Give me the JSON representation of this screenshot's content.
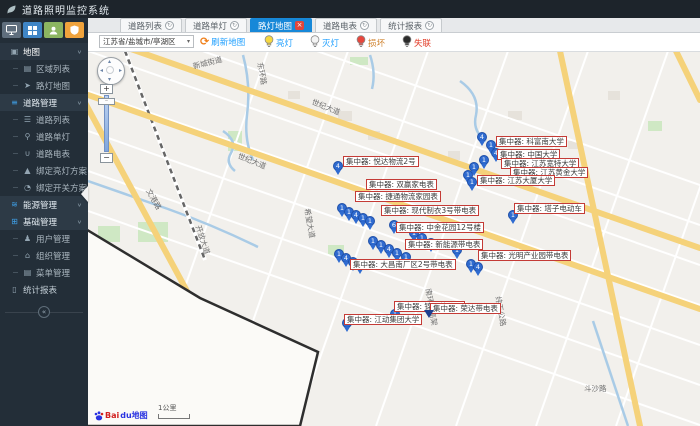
{
  "app": {
    "title": "道路照明监控系统"
  },
  "ui": {
    "refresh_glyph": "↻",
    "close_glyph": "×",
    "chevron": "∨",
    "caret": "▾",
    "collapse_glyph": "«",
    "refresh_icon_glyph": "⟳",
    "zoom_in": "+",
    "zoom_out": "−",
    "handle_glyph": "‒"
  },
  "sidebar": {
    "quick_buttons": [
      {
        "id": "monitor",
        "color": "#5f6e7d"
      },
      {
        "id": "grid",
        "color": "#3f85c6"
      },
      {
        "id": "user",
        "color": "#8cb561"
      },
      {
        "id": "shield",
        "color": "#f0a33c"
      }
    ],
    "items": [
      {
        "id": "map",
        "label": "地图",
        "icon": "▣",
        "child": false,
        "chevron": true,
        "accent": false,
        "active": true
      },
      {
        "id": "region-list",
        "label": "区域列表",
        "icon": "▤",
        "child": true,
        "chevron": false,
        "accent": false,
        "active": false
      },
      {
        "id": "lamp-map",
        "label": "路灯地图",
        "icon": "➤",
        "child": true,
        "chevron": false,
        "accent": false,
        "active": false
      },
      {
        "id": "road-manage",
        "label": "道路管理",
        "icon": "≡",
        "child": false,
        "chevron": true,
        "accent": true,
        "active": false
      },
      {
        "id": "road-list",
        "label": "道路列表",
        "icon": "☰",
        "child": true,
        "chevron": false,
        "accent": false,
        "active": false
      },
      {
        "id": "road-lamp",
        "label": "道路单灯",
        "icon": "⚲",
        "child": true,
        "chevron": false,
        "accent": false,
        "active": false
      },
      {
        "id": "road-meter",
        "label": "道路电表",
        "icon": "∪",
        "child": true,
        "chevron": false,
        "accent": false,
        "active": false
      },
      {
        "id": "bind-light-plan",
        "label": "绑定亮灯方案",
        "icon": "▲",
        "child": true,
        "chevron": false,
        "accent": false,
        "active": false
      },
      {
        "id": "bind-switch-plan",
        "label": "绑定开关方案",
        "icon": "◔",
        "child": true,
        "chevron": false,
        "accent": false,
        "active": false
      },
      {
        "id": "energy-manage",
        "label": "能源管理",
        "icon": "≋",
        "child": false,
        "chevron": true,
        "accent": true,
        "active": false
      },
      {
        "id": "base-manage",
        "label": "基础管理",
        "icon": "⊞",
        "child": false,
        "chevron": true,
        "accent": true,
        "active": false
      },
      {
        "id": "user-manage",
        "label": "用户管理",
        "icon": "♟",
        "child": true,
        "chevron": false,
        "accent": false,
        "active": false
      },
      {
        "id": "org-manage",
        "label": "组织管理",
        "icon": "⌂",
        "child": true,
        "chevron": false,
        "accent": false,
        "active": false
      },
      {
        "id": "menu-manage",
        "label": "菜单管理",
        "icon": "▤",
        "child": true,
        "chevron": false,
        "accent": false,
        "active": false
      },
      {
        "id": "report",
        "label": "统计报表",
        "icon": "▯",
        "child": false,
        "chevron": false,
        "accent": false,
        "active": false
      }
    ]
  },
  "tabs": [
    {
      "id": "road-list",
      "label": "道路列表",
      "active": false
    },
    {
      "id": "road-lamp",
      "label": "道路单灯",
      "active": false
    },
    {
      "id": "lamp-map",
      "label": "路灯地图",
      "active": true
    },
    {
      "id": "road-meter",
      "label": "道路电表",
      "active": false
    },
    {
      "id": "report",
      "label": "统计报表",
      "active": false
    }
  ],
  "toolbar": {
    "region_select": "江苏省/盐城市/亭湖区",
    "refresh_label": "刷新地图",
    "legend": [
      {
        "id": "on",
        "label": "亮灯",
        "bulb": "#f7d83f",
        "text_color": "#1E9FFF"
      },
      {
        "id": "off",
        "label": "灭灯",
        "bulb": "#f4f4f4",
        "text_color": "#1E9FFF"
      },
      {
        "id": "broken",
        "label": "损坏",
        "bulb": "#e8463c",
        "text_color": "#cf822e"
      },
      {
        "id": "offline",
        "label": "失联",
        "bulb": "#2b2b2b",
        "text_color": "#e23c28"
      }
    ]
  },
  "map": {
    "scale_label": "1公里",
    "logo_text_1": "Bai",
    "logo_text_2": "du地图",
    "road_labels": [
      {
        "text": "新城街道",
        "x": 193,
        "y": 61,
        "rot": -14
      },
      {
        "text": "东环路",
        "x": 260,
        "y": 57,
        "rot": 80
      },
      {
        "text": "世纪大道",
        "x": 312,
        "y": 96,
        "rot": 22
      },
      {
        "text": "世纪大道",
        "x": 238,
        "y": 150,
        "rot": 22
      },
      {
        "text": "文港路",
        "x": 148,
        "y": 184,
        "rot": 60
      },
      {
        "text": "开放大道",
        "x": 198,
        "y": 220,
        "rot": 72
      },
      {
        "text": "希望大道",
        "x": 307,
        "y": 203,
        "rot": 80
      },
      {
        "text": "南环路高架",
        "x": 428,
        "y": 283,
        "rot": 80
      },
      {
        "text": "纬五公路",
        "x": 498,
        "y": 291,
        "rot": 80
      },
      {
        "text": "斗沙路",
        "x": 584,
        "y": 383,
        "rot": 0
      }
    ],
    "labels": [
      {
        "x": 343,
        "y": 156,
        "text": "集中器: 悦达物流2号"
      },
      {
        "x": 366,
        "y": 179,
        "text": "集中器: 双赢家电表"
      },
      {
        "x": 355,
        "y": 191,
        "text": "集中器: 捷通物流家园表"
      },
      {
        "x": 381,
        "y": 205,
        "text": "集中器: 现代制衣3号带电表"
      },
      {
        "x": 396,
        "y": 222,
        "text": "集中器: 中金花园12号楼"
      },
      {
        "x": 405,
        "y": 239,
        "text": "集中器: 新能源带电表"
      },
      {
        "x": 350,
        "y": 259,
        "text": "集中器: 大昌南厂区2号带电表"
      },
      {
        "x": 478,
        "y": 250,
        "text": "集中器: 光明产业园带电表"
      },
      {
        "x": 496,
        "y": 136,
        "text": "集中器: 科富南大学"
      },
      {
        "x": 497,
        "y": 149,
        "text": "集中器: 中国大学"
      },
      {
        "x": 501,
        "y": 158,
        "text": "集中器: 江苏宽特大学"
      },
      {
        "x": 510,
        "y": 167,
        "text": "集中器: 江苏黄金大学"
      },
      {
        "x": 477,
        "y": 175,
        "text": "集中器: 江苏大厦大学"
      },
      {
        "x": 514,
        "y": 203,
        "text": "集中器: 塔子电动车"
      },
      {
        "x": 394,
        "y": 301,
        "text": "集中器: 锦厂幼儿园"
      },
      {
        "x": 430,
        "y": 303,
        "text": "集中器: 荣达带电表"
      },
      {
        "x": 344,
        "y": 314,
        "text": "集中器: 江动集团大学"
      }
    ],
    "markers": [
      [
        333,
        161,
        "4"
      ],
      [
        337,
        203,
        "1"
      ],
      [
        344,
        207,
        "1"
      ],
      [
        351,
        210,
        "4"
      ],
      [
        358,
        213,
        "1"
      ],
      [
        365,
        216,
        "1"
      ],
      [
        334,
        249,
        "1"
      ],
      [
        341,
        253,
        "4"
      ],
      [
        348,
        257,
        "1"
      ],
      [
        355,
        260,
        "1"
      ],
      [
        368,
        236,
        "1"
      ],
      [
        376,
        240,
        "1"
      ],
      [
        384,
        244,
        "4"
      ],
      [
        392,
        248,
        "1"
      ],
      [
        401,
        252,
        "1"
      ],
      [
        389,
        220,
        "6"
      ],
      [
        409,
        228,
        "1"
      ],
      [
        417,
        233,
        "1"
      ],
      [
        426,
        238,
        "1"
      ],
      [
        342,
        318,
        "1"
      ],
      [
        390,
        309,
        "1"
      ],
      [
        477,
        132,
        "4"
      ],
      [
        486,
        140,
        "1"
      ],
      [
        491,
        148,
        "4"
      ],
      [
        479,
        155,
        "1"
      ],
      [
        469,
        162,
        "1"
      ],
      [
        463,
        170,
        "1"
      ],
      [
        467,
        177,
        "1"
      ],
      [
        508,
        210,
        "1"
      ],
      [
        452,
        245,
        "1"
      ],
      [
        466,
        259,
        "1"
      ],
      [
        473,
        262,
        "4"
      ]
    ],
    "arrow_marker": {
      "x": 424,
      "y": 310
    }
  }
}
